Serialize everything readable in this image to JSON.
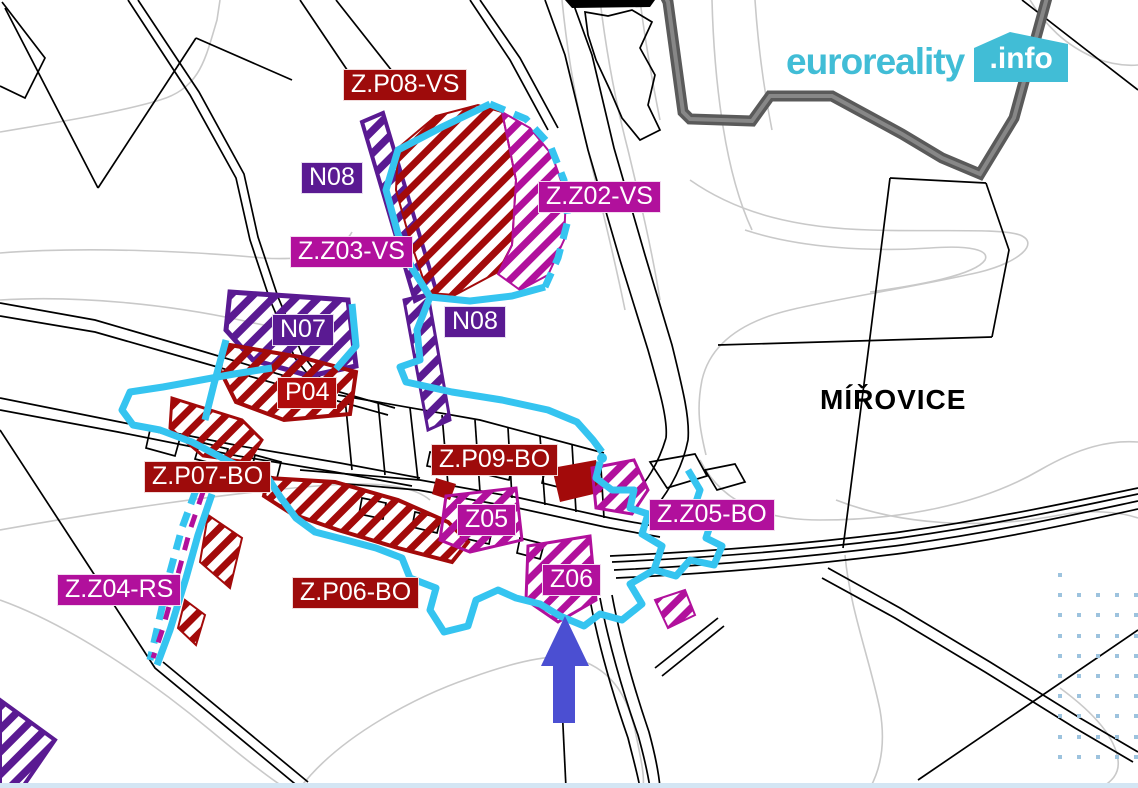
{
  "logo": {
    "brand": "euroreality",
    "tld": ".info",
    "color": "#41bdd6"
  },
  "map": {
    "place_name": "MÍŘOVICE",
    "marker": {
      "shape": "arrow-up",
      "color": "#4b4fd2"
    },
    "colors": {
      "zone_dark_red": "#9e0b0b",
      "zone_bright_red": "#b00c0c",
      "zone_purple": "#5a1a92",
      "zone_magenta": "#b1109c",
      "boundary_cyan": "#35c4f0",
      "municipal_boundary_gray": "#5a5a5a",
      "contour_gray": "#c9c9c9",
      "watermark_dots": "#9dc3de"
    },
    "labels": [
      {
        "code": "Z.P08-VS",
        "x": 343,
        "y": 69,
        "bg": "#9e0b0b"
      },
      {
        "code": "N08",
        "x": 301,
        "y": 162,
        "bg": "#5a1a92"
      },
      {
        "code": "Z.Z02-VS",
        "x": 538,
        "y": 181,
        "bg": "#b1109c"
      },
      {
        "code": "Z.Z03-VS",
        "x": 290,
        "y": 236,
        "bg": "#b1109c"
      },
      {
        "code": "N07",
        "x": 272,
        "y": 314,
        "bg": "#5a1a92"
      },
      {
        "code": "N08",
        "x": 444,
        "y": 306,
        "bg": "#5a1a92"
      },
      {
        "code": "P04",
        "x": 277,
        "y": 377,
        "bg": "#b00c0c"
      },
      {
        "code": "Z.P09-BO",
        "x": 431,
        "y": 444,
        "bg": "#9e0b0b"
      },
      {
        "code": "Z.P07-BO",
        "x": 144,
        "y": 461,
        "bg": "#9e0b0b"
      },
      {
        "code": "Z05",
        "x": 457,
        "y": 504,
        "bg": "#b1109c"
      },
      {
        "code": "Z.Z05-BO",
        "x": 649,
        "y": 499,
        "bg": "#b1109c"
      },
      {
        "code": "Z06",
        "x": 542,
        "y": 564,
        "bg": "#b1109c"
      },
      {
        "code": "Z.Z04-RS",
        "x": 57,
        "y": 574,
        "bg": "#b1109c"
      },
      {
        "code": "Z.P06-BO",
        "x": 292,
        "y": 577,
        "bg": "#9e0b0b"
      }
    ]
  }
}
